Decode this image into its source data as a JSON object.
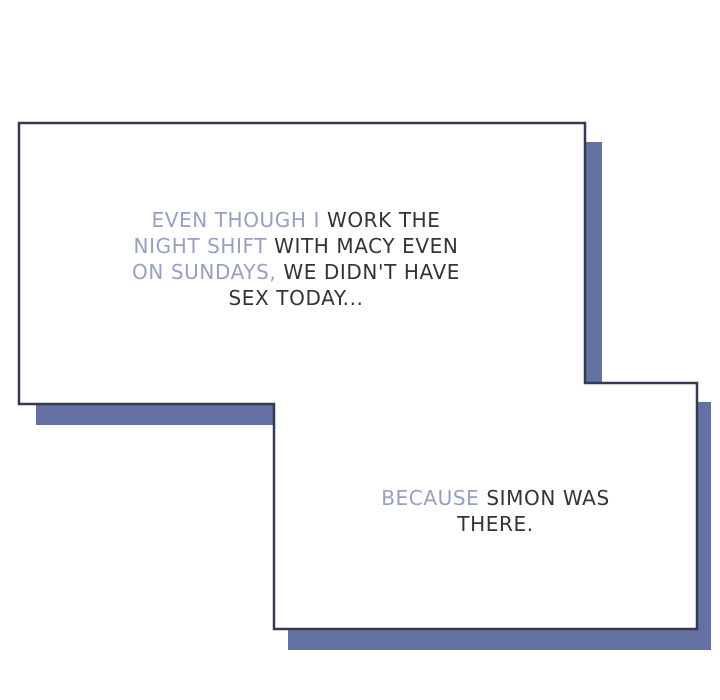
{
  "page": {
    "background": "#ffffff",
    "kind": "comic-panel"
  },
  "colors": {
    "panel_fill": "#ffffff",
    "panel_border": "#333a52",
    "shadow": "#6470a2",
    "text_highlight": "#98a0c1",
    "text_dark": "#33343a"
  },
  "panels": [
    {
      "name": "top-caption-box",
      "lines": [
        {
          "highlight": "EVEN THOUGH I",
          "rest": " WORK THE"
        },
        {
          "highlight": "NIGHT SHIFT",
          "rest": " WITH MACY EVEN"
        },
        {
          "highlight": "ON SUNDAYS,",
          "rest": " WE DIDN'T HAVE"
        },
        {
          "highlight": "",
          "rest": "SEX TODAY..."
        }
      ]
    },
    {
      "name": "bottom-caption-box",
      "lines": [
        {
          "highlight": "BECAUSE",
          "rest": " SIMON WAS"
        },
        {
          "highlight": "",
          "rest": "THERE."
        }
      ]
    }
  ]
}
